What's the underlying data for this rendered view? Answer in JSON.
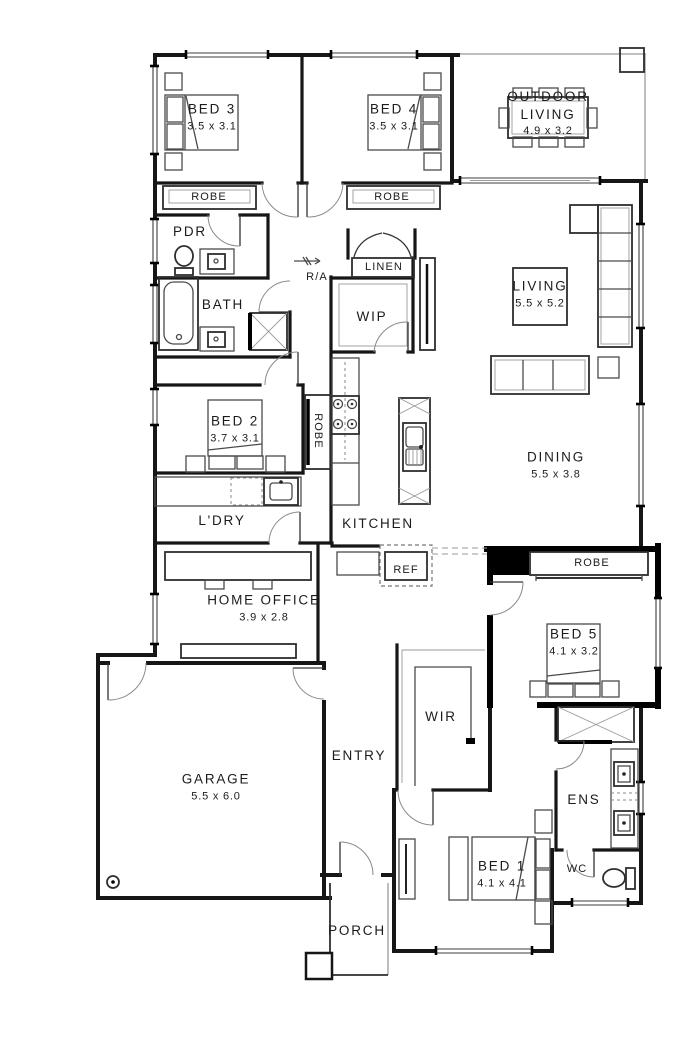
{
  "drawing": {
    "type": "residential floor plan",
    "colors": {
      "background": "#ffffff",
      "wall": "#161616",
      "highlight_wall": "#000000",
      "furniture": "#4a4a4a",
      "open_edge": "#9a9a9a"
    }
  },
  "rooms": {
    "bed3": {
      "name": "BED 3",
      "dims": "3.5 x 3.1"
    },
    "bed4": {
      "name": "BED 4",
      "dims": "3.5 x 3.1"
    },
    "outdoor_living": {
      "name": "OUTDOOR LIVING",
      "dims": "4.9 x 3.2"
    },
    "robe_bed3": {
      "name": "ROBE"
    },
    "robe_bed4": {
      "name": "ROBE"
    },
    "pdr": {
      "name": "PDR"
    },
    "bath": {
      "name": "BATH"
    },
    "return_air": {
      "name": "R/A"
    },
    "linen": {
      "name": "LINEN"
    },
    "wip": {
      "name": "WIP"
    },
    "living": {
      "name": "LIVING",
      "dims": "5.5 x 5.2"
    },
    "bed2": {
      "name": "BED 2",
      "dims": "3.7 x 3.1"
    },
    "robe_bed2": {
      "name": "ROBE"
    },
    "dining": {
      "name": "DINING",
      "dims": "5.5 x 3.8"
    },
    "ldry": {
      "name": "L'DRY"
    },
    "kitchen": {
      "name": "KITCHEN"
    },
    "ref": {
      "name": "REF"
    },
    "home_office": {
      "name": "HOME OFFICE",
      "dims": "3.9 x 2.8"
    },
    "robe_bed5": {
      "name": "ROBE"
    },
    "bed5": {
      "name": "BED 5",
      "dims": "4.1 x 3.2"
    },
    "garage": {
      "name": "GARAGE",
      "dims": "5.5 x 6.0"
    },
    "entry": {
      "name": "ENTRY"
    },
    "wir": {
      "name": "WIR"
    },
    "ens": {
      "name": "ENS"
    },
    "bed1": {
      "name": "BED 1",
      "dims": "4.1 x 4.1"
    },
    "wc": {
      "name": "WC"
    },
    "porch": {
      "name": "PORCH"
    }
  }
}
